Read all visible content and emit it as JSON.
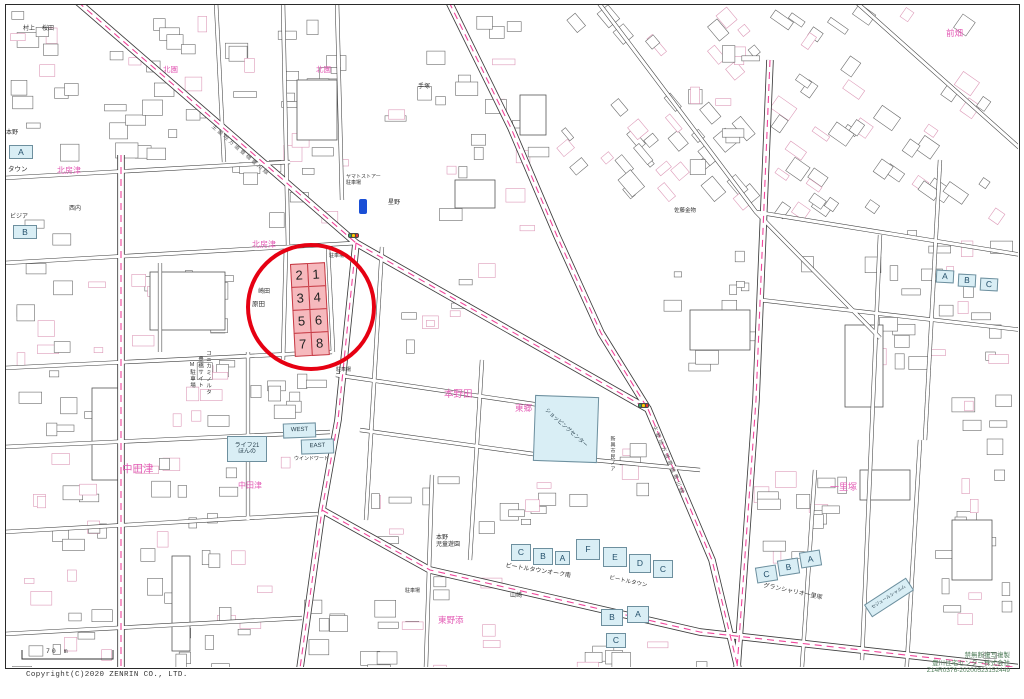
{
  "colors": {
    "area_label": "#e35bb5",
    "poi_label": "#333333",
    "road_label": "#5f5f5f",
    "road_dash": "#f0459b",
    "highlight_circle": "#e60012",
    "lot_fill": "#f6b9bd",
    "lot_border": "#c63a44",
    "blue_building_fill": "#d9eef5",
    "signal_colors": [
      "#33aa66",
      "#ffcc00",
      "#ee3333"
    ]
  },
  "scale_bar": {
    "label": "70 m"
  },
  "footer": {
    "copyright": "Copyright(C)2020 ZENRIN CO., LTD.",
    "attribution_lines": [
      "禁無断複写複製",
      "豊川住宅センター株式会社",
      "Z14R0376-20200523152449"
    ]
  },
  "highlight": {
    "lots": [
      {
        "no": "2"
      },
      {
        "no": "1"
      },
      {
        "no": "3"
      },
      {
        "no": "4"
      },
      {
        "no": "5"
      },
      {
        "no": "6"
      },
      {
        "no": "7"
      },
      {
        "no": "8"
      }
    ]
  },
  "map": {
    "labels": [
      {
        "type": "area",
        "text": "北房津",
        "x": 57,
        "y": 167,
        "size": 8
      },
      {
        "type": "area",
        "text": "北園",
        "x": 163,
        "y": 66,
        "size": 7.5
      },
      {
        "type": "area",
        "text": "北園",
        "x": 316,
        "y": 66,
        "size": 7.5
      },
      {
        "type": "area",
        "text": "北房津",
        "x": 252,
        "y": 241,
        "size": 8
      },
      {
        "type": "area",
        "text": "中田津",
        "x": 122,
        "y": 464,
        "size": 10.5
      },
      {
        "type": "area",
        "text": "中田津",
        "x": 238,
        "y": 482,
        "size": 8
      },
      {
        "type": "area",
        "text": "本野田",
        "x": 444,
        "y": 390,
        "size": 9.5
      },
      {
        "type": "area",
        "text": "東郷",
        "x": 515,
        "y": 404,
        "size": 8.5
      },
      {
        "type": "area",
        "text": "前畑",
        "x": 946,
        "y": 29,
        "size": 8.5
      },
      {
        "type": "area",
        "text": "一里塚",
        "x": 830,
        "y": 483,
        "size": 9
      },
      {
        "type": "area",
        "text": "東野添",
        "x": 438,
        "y": 616,
        "size": 8.5
      },
      {
        "type": "poi",
        "text": "村上",
        "x": 23,
        "y": 26,
        "size": 6
      },
      {
        "type": "poi",
        "text": "桜田",
        "x": 42,
        "y": 26,
        "size": 6
      },
      {
        "type": "poi",
        "text": "本野",
        "x": 6,
        "y": 130,
        "size": 6
      },
      {
        "type": "poi",
        "text": "タウン",
        "x": 8,
        "y": 166,
        "size": 6.5
      },
      {
        "type": "poi",
        "text": "ビジア",
        "x": 10,
        "y": 214,
        "size": 6
      },
      {
        "type": "poi",
        "text": "崎田",
        "x": 258,
        "y": 289,
        "size": 6
      },
      {
        "type": "poi",
        "text": "原田",
        "x": 252,
        "y": 301,
        "size": 6.5
      },
      {
        "type": "poi",
        "text": "星野",
        "x": 388,
        "y": 200,
        "size": 6
      },
      {
        "type": "poi",
        "text": "手塚",
        "x": 418,
        "y": 84,
        "size": 6
      },
      {
        "type": "poi",
        "text": "佐藤金物",
        "x": 674,
        "y": 208,
        "size": 5.5
      },
      {
        "type": "poi",
        "text": "西内",
        "x": 69,
        "y": 206,
        "size": 6
      },
      {
        "type": "poi",
        "text": "ウインドワード",
        "x": 294,
        "y": 457,
        "size": 5
      },
      {
        "type": "poi",
        "text": "山崎",
        "x": 510,
        "y": 593,
        "size": 6
      },
      {
        "type": "poi",
        "text": "本野\n児童遊園",
        "x": 436,
        "y": 535,
        "size": 6
      },
      {
        "type": "poi",
        "text": "駐車場",
        "x": 329,
        "y": 254,
        "size": 5
      },
      {
        "type": "poi",
        "text": "駐車場",
        "x": 336,
        "y": 368,
        "size": 5
      },
      {
        "type": "poi",
        "text": "駐車場",
        "x": 405,
        "y": 589,
        "size": 5
      },
      {
        "type": "poi",
        "text": "ヤマトストアー\n駐車場",
        "x": 346,
        "y": 175,
        "size": 5
      },
      {
        "type": "poi",
        "text": "グランシャリオ一里塚",
        "x": 764,
        "y": 583,
        "size": 6,
        "rot": 12
      },
      {
        "type": "poi",
        "text": "ビートルタウンオーク南",
        "x": 506,
        "y": 563,
        "size": 6,
        "rot": 9
      },
      {
        "type": "poi",
        "text": "ビートルタウン",
        "x": 610,
        "y": 575,
        "size": 5.5,
        "rot": 12
      },
      {
        "type": "poi",
        "text": "コニカミノルタ",
        "x": 205,
        "y": 350,
        "size": 5.5,
        "vertical": true
      },
      {
        "type": "poi",
        "text": "豊橋サイト",
        "x": 197,
        "y": 356,
        "size": 5.5,
        "vertical": true
      },
      {
        "type": "poi",
        "text": "M駐車場",
        "x": 189,
        "y": 362,
        "size": 5.5,
        "vertical": true
      },
      {
        "type": "poi",
        "text": "新興市民ノア",
        "x": 609,
        "y": 436,
        "size": 5,
        "vertical": true
      },
      {
        "type": "road",
        "text": "主要地方道豊橋豊川線",
        "x": 214,
        "y": 124,
        "size": 5.5,
        "rot": 41
      },
      {
        "type": "road",
        "text": "主要地方道豊橋豊川線",
        "x": 656,
        "y": 425,
        "size": 5.5,
        "rot": 67
      }
    ],
    "buildings": [
      {
        "kind": "named",
        "label": "WEST",
        "x": 283,
        "y": 423,
        "w": 33,
        "h": 15,
        "rot": -2,
        "label_size": 6
      },
      {
        "kind": "named",
        "label": "EAST",
        "x": 301,
        "y": 439,
        "w": 33,
        "h": 15,
        "rot": -2,
        "label_size": 6
      },
      {
        "kind": "named",
        "label": "ライフ21\nほんの",
        "x": 227,
        "y": 436,
        "w": 40,
        "h": 26,
        "rot": 0,
        "label_size": 6
      },
      {
        "kind": "named",
        "label": "ショッピングセンター",
        "x": 534,
        "y": 396,
        "w": 64,
        "h": 66,
        "rot": 2,
        "label_size": 5.5,
        "label_rot": 40
      },
      {
        "kind": "named",
        "label": "セジュールシャルム",
        "x": 864,
        "y": 590,
        "w": 50,
        "h": 15,
        "rot": -33,
        "label_size": 4.5
      },
      {
        "kind": "letter",
        "label": "C",
        "x": 511,
        "y": 544,
        "w": 20,
        "h": 17,
        "rot": 0
      },
      {
        "kind": "letter",
        "label": "B",
        "x": 533,
        "y": 548,
        "w": 20,
        "h": 17,
        "rot": 0
      },
      {
        "kind": "letter",
        "label": "A",
        "x": 555,
        "y": 551,
        "w": 15,
        "h": 14,
        "rot": 0
      },
      {
        "kind": "letter",
        "label": "F",
        "x": 576,
        "y": 539,
        "w": 24,
        "h": 21,
        "rot": 0
      },
      {
        "kind": "letter",
        "label": "E",
        "x": 603,
        "y": 547,
        "w": 24,
        "h": 20,
        "rot": 0
      },
      {
        "kind": "letter",
        "label": "D",
        "x": 629,
        "y": 554,
        "w": 22,
        "h": 19,
        "rot": 0
      },
      {
        "kind": "letter",
        "label": "C",
        "x": 653,
        "y": 560,
        "w": 20,
        "h": 18,
        "rot": 0
      },
      {
        "kind": "letter",
        "label": "B",
        "x": 601,
        "y": 609,
        "w": 22,
        "h": 17,
        "rot": 0
      },
      {
        "kind": "letter",
        "label": "A",
        "x": 627,
        "y": 606,
        "w": 22,
        "h": 17,
        "rot": 0
      },
      {
        "kind": "letter",
        "label": "C",
        "x": 606,
        "y": 633,
        "w": 20,
        "h": 15,
        "rot": 0
      },
      {
        "kind": "letter",
        "label": "C",
        "x": 756,
        "y": 566,
        "w": 21,
        "h": 16,
        "rot": -9
      },
      {
        "kind": "letter",
        "label": "B",
        "x": 778,
        "y": 559,
        "w": 21,
        "h": 16,
        "rot": -9
      },
      {
        "kind": "letter",
        "label": "A",
        "x": 800,
        "y": 551,
        "w": 21,
        "h": 16,
        "rot": -9
      },
      {
        "kind": "letter",
        "label": "A",
        "x": 936,
        "y": 270,
        "w": 18,
        "h": 13,
        "rot": 3
      },
      {
        "kind": "letter",
        "label": "B",
        "x": 958,
        "y": 274,
        "w": 18,
        "h": 13,
        "rot": 3
      },
      {
        "kind": "letter",
        "label": "C",
        "x": 980,
        "y": 278,
        "w": 18,
        "h": 13,
        "rot": 3
      },
      {
        "kind": "letter",
        "label": "A",
        "x": 9,
        "y": 145,
        "w": 24,
        "h": 14,
        "rot": 0
      },
      {
        "kind": "letter",
        "label": "B",
        "x": 13,
        "y": 225,
        "w": 24,
        "h": 14,
        "rot": 0
      }
    ],
    "icons": [
      {
        "name": "traffic-signal-icon",
        "x": 348,
        "y": 233
      },
      {
        "name": "traffic-signal-icon",
        "x": 638,
        "y": 403
      },
      {
        "name": "route-marker-icon",
        "x": 359,
        "y": 199
      }
    ]
  }
}
